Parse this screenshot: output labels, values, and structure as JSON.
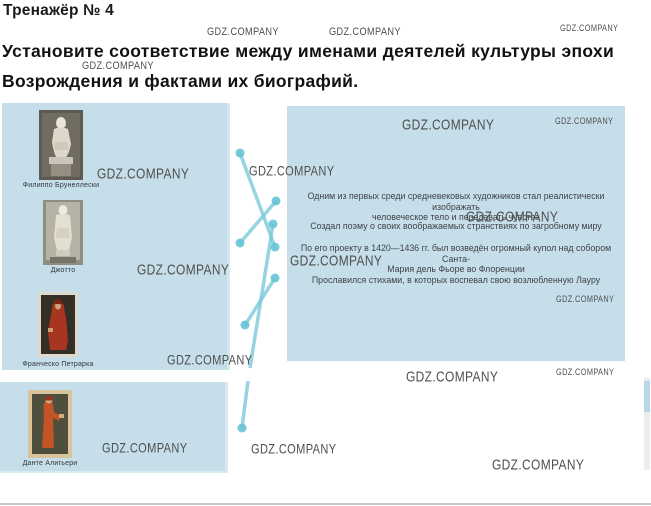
{
  "title": "Тренажёр № 4",
  "instruction": "Установите соответствие между именами деятелей культуры эпохи Возрождения и фактами их биографий.",
  "watermark_text": "GDZ.COMPANY",
  "colors": {
    "panel_bg": "#c5dee9",
    "connector_line": "#7cc9da",
    "connector_dot": "#66c3d6",
    "watermark_gray": "#4f4f4f"
  },
  "people": {
    "items": [
      {
        "label": "Филиппо Брунеллески"
      },
      {
        "label": "Джотто"
      },
      {
        "label": "Франческо Петрарка"
      },
      {
        "label": "Данте Алигьери"
      }
    ]
  },
  "facts": {
    "items": [
      {
        "text": "Одним из первых среди средневековых художников стал реалистически изображать\nчеловеческое тело и передавать чувства"
      },
      {
        "text": "Создал поэму о своих воображаемых странствиях по загробному миру"
      },
      {
        "text": "По его проекту в 1420—1436 гг. был возведён огромный купол над собором Санта-\nМария дель Фьоре во Флоренции"
      },
      {
        "text": "Прославился стихами, в которых воспевал свою возлюбленную Лауру"
      }
    ]
  },
  "connections": {
    "matches": [
      {
        "person": "Филиппо Брунеллески",
        "fact_index": 2
      },
      {
        "person": "Джотто",
        "fact_index": 0
      },
      {
        "person": "Франческо Петрарка",
        "fact_index": 3
      },
      {
        "person": "Данте Алигьери",
        "fact_index": 1
      }
    ],
    "segments": [
      {
        "x1": 240,
        "y1": 153,
        "x2": 275,
        "y2": 247,
        "dot_start": true,
        "dot_end": true
      },
      {
        "x1": 240,
        "y1": 243,
        "x2": 276,
        "y2": 201,
        "dot_start": true,
        "dot_end": true
      },
      {
        "x1": 245,
        "y1": 325,
        "x2": 275,
        "y2": 278,
        "dot_start": true,
        "dot_end": true
      },
      {
        "x1": 242,
        "y1": 428,
        "x2": 248,
        "y2": 381,
        "dot_start": true,
        "dot_end": false
      },
      {
        "x1": 250,
        "y1": 368,
        "x2": 273,
        "y2": 224,
        "dot_start": false,
        "dot_end": true
      }
    ]
  },
  "watermarks": [
    {
      "x": 207,
      "y": 26,
      "s": 10
    },
    {
      "x": 329,
      "y": 26,
      "s": 10
    },
    {
      "x": 560,
      "y": 23,
      "s": 8
    },
    {
      "x": 82,
      "y": 60,
      "s": 10
    },
    {
      "x": 97,
      "y": 165,
      "s": 13
    },
    {
      "x": 249,
      "y": 163,
      "s": 12
    },
    {
      "x": 402,
      "y": 116,
      "s": 13
    },
    {
      "x": 555,
      "y": 116,
      "s": 8
    },
    {
      "x": 466,
      "y": 208,
      "s": 13
    },
    {
      "x": 137,
      "y": 261,
      "s": 13
    },
    {
      "x": 290,
      "y": 252,
      "s": 13
    },
    {
      "x": 167,
      "y": 352,
      "s": 12
    },
    {
      "x": 556,
      "y": 294,
      "s": 8
    },
    {
      "x": 406,
      "y": 368,
      "s": 13
    },
    {
      "x": 556,
      "y": 367,
      "s": 8
    },
    {
      "x": 102,
      "y": 440,
      "s": 12
    },
    {
      "x": 251,
      "y": 441,
      "s": 12
    },
    {
      "x": 492,
      "y": 456,
      "s": 13
    }
  ]
}
